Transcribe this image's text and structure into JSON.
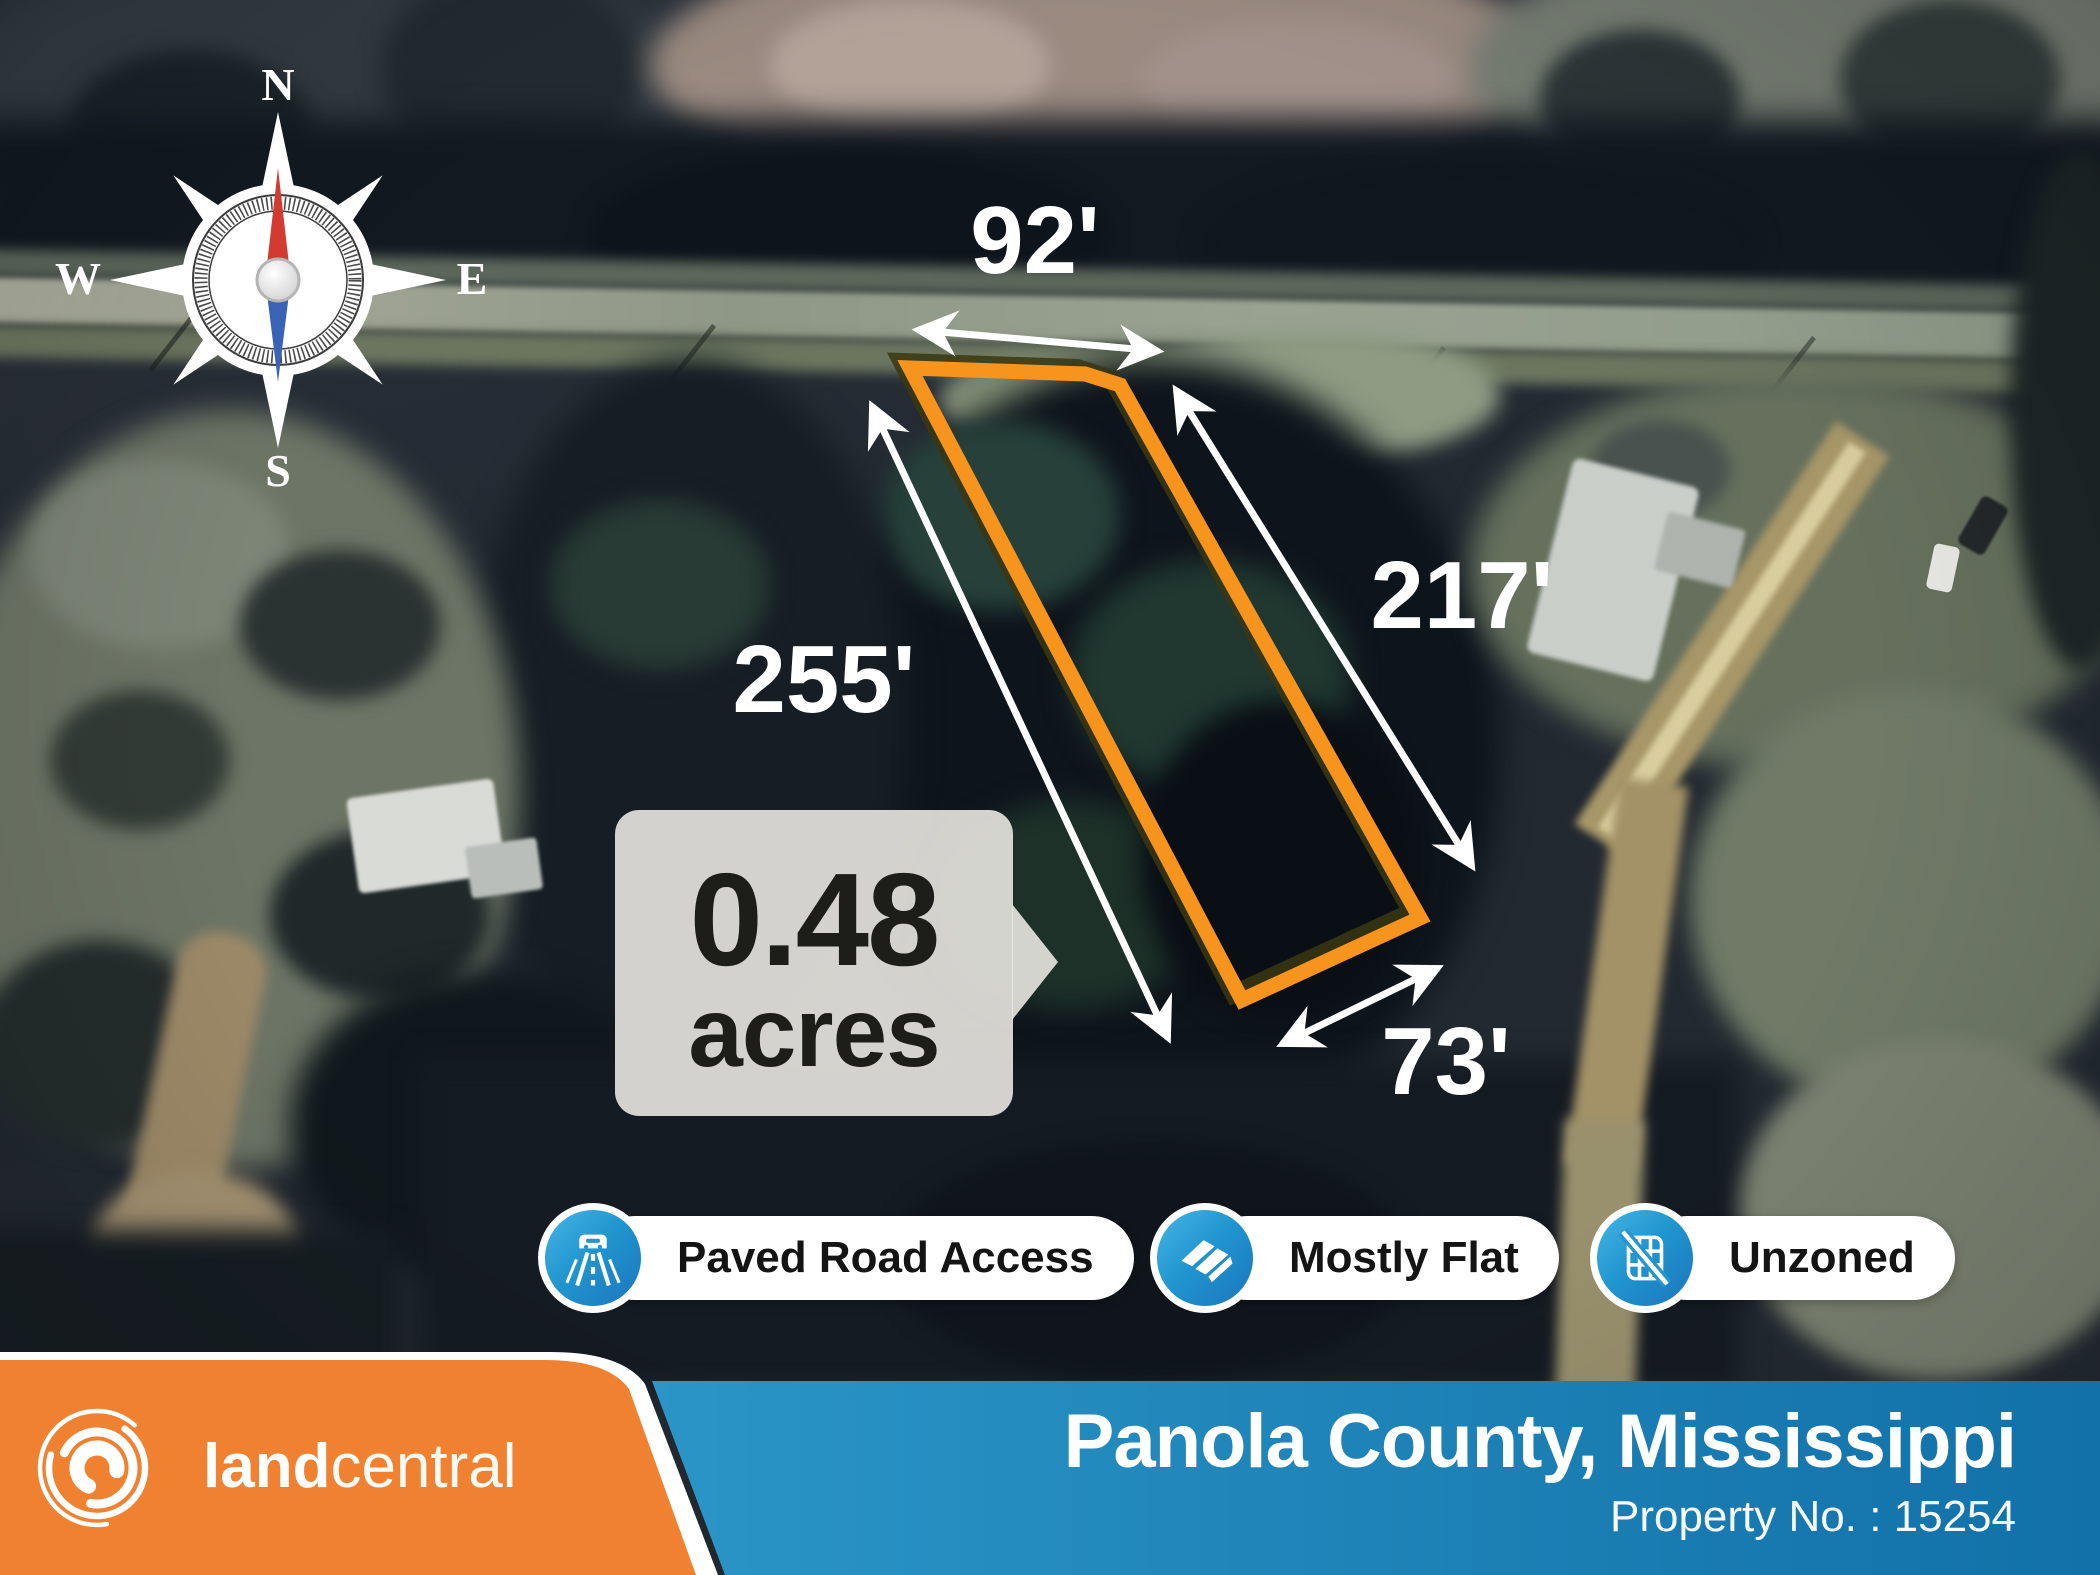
{
  "map": {
    "compass": {
      "n": "N",
      "e": "E",
      "s": "S",
      "w": "W"
    },
    "dimensions": {
      "top": "92'",
      "left": "255'",
      "right": "217'",
      "bottom": "73'"
    },
    "area_callout": {
      "value": "0.48",
      "unit": "acres"
    },
    "badges": [
      {
        "label": "Paved Road Access",
        "icon": "paved-road-icon"
      },
      {
        "label": "Mostly Flat",
        "icon": "mostly-flat-icon"
      },
      {
        "label": "Unzoned",
        "icon": "unzoned-icon"
      }
    ]
  },
  "footer": {
    "brand_bold": "land",
    "brand_light": "central",
    "location": "Panola County, Mississippi",
    "property_no": "Property No. : 15254"
  },
  "colors": {
    "parcel_outline": "#F7941E",
    "brand_orange": "#F08130",
    "footer_blue": "#1B80B4",
    "badge_blue": "#2196CF"
  }
}
